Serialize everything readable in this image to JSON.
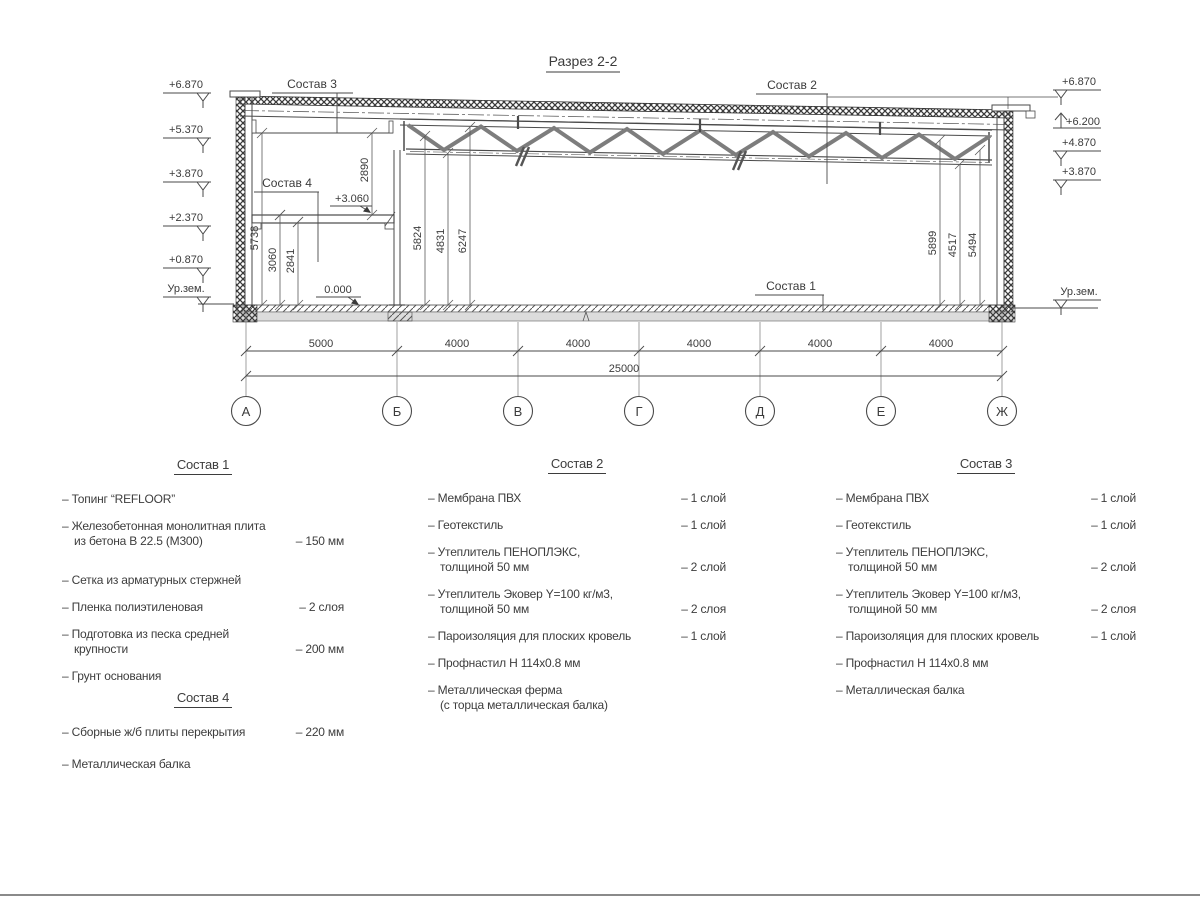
{
  "title": "Разрез 2-2",
  "elev_left": [
    "+6.870",
    "+5.370",
    "+3.870",
    "+2.370",
    "+0.870",
    "Ур.зем."
  ],
  "elev_right": [
    "+6.870",
    "+6.200",
    "+4.870",
    "+3.870",
    "Ур.зем."
  ],
  "levels": {
    "mezz": "+3.060",
    "floor": "0.000"
  },
  "callouts": {
    "sostav1": "Состав 1",
    "sostav2": "Состав 2",
    "sostav3": "Состав 3",
    "sostav4": "Состав 4"
  },
  "vdims_left": [
    "5738",
    "3060",
    "2841",
    "2890"
  ],
  "vdims_mid": [
    "5824",
    "4831",
    "6247"
  ],
  "vdims_right": [
    "5899",
    "4517",
    "5494"
  ],
  "axes": [
    "А",
    "Б",
    "В",
    "Г",
    "Д",
    "Е",
    "Ж"
  ],
  "span_dims": [
    "5000",
    "4000",
    "4000",
    "4000",
    "4000",
    "4000"
  ],
  "total_dim": "25000",
  "lists": [
    {
      "id": "sostav1",
      "title": "Состав 1",
      "items": [
        {
          "name": "– Топинг “REFLOOR”",
          "value": ""
        },
        {
          "name": "– Железобетонная  монолитная плита\nиз бетона В 22.5 (М300)",
          "value": "– 150 мм"
        },
        {
          "name": "– Сетка из арматурных стержней",
          "value": ""
        },
        {
          "name": "– Пленка полиэтиленовая",
          "value": "–  2 слоя"
        },
        {
          "name": "– Подготовка из песка средней\nкрупности",
          "value": "– 200 мм"
        },
        {
          "name": "– Грунт основания",
          "value": ""
        }
      ]
    },
    {
      "id": "sostav4",
      "title": "Состав 4",
      "items": [
        {
          "name": "– Сборные ж/б плиты перекрытия",
          "value": "– 220 мм"
        },
        {
          "name": "– Металлическая балка",
          "value": ""
        }
      ]
    },
    {
      "id": "sostav2",
      "title": "Состав 2",
      "items": [
        {
          "name": "– Мембрана ПВХ",
          "value": "– 1 слой"
        },
        {
          "name": "– Геотекстиль",
          "value": "– 1 слой"
        },
        {
          "name": "– Утеплитель ПЕНОПЛЭКС,\nтолщиной 50 мм",
          "value": "– 2 слой"
        },
        {
          "name": "– Утеплитель Эковер Y=100 кг/м3,\nтолщиной 50 мм",
          "value": "– 2 слоя"
        },
        {
          "name": "– Пароизоляция для плоских кровель",
          "value": "– 1 слой"
        },
        {
          "name": "– Профнастил Н 114х0.8 мм",
          "value": ""
        },
        {
          "name": "– Металлическая ферма\n(с торца металлическая балка)",
          "value": ""
        }
      ]
    },
    {
      "id": "sostav3",
      "title": "Состав 3",
      "items": [
        {
          "name": "– Мембрана ПВХ",
          "value": "– 1 слой"
        },
        {
          "name": "– Геотекстиль",
          "value": "– 1 слой"
        },
        {
          "name": "– Утеплитель ПЕНОПЛЭКС,\nтолщиной 50 мм",
          "value": "– 2 слой"
        },
        {
          "name": "– Утеплитель Эковер Y=100 кг/м3,\nтолщиной 50 мм",
          "value": "– 2 слоя"
        },
        {
          "name": "– Пароизоляция для плоских кровель",
          "value": "– 1 слой"
        },
        {
          "name": "– Профнастил Н 114х0.8 мм",
          "value": ""
        },
        {
          "name": "– Металлическая балка",
          "value": ""
        }
      ]
    }
  ]
}
